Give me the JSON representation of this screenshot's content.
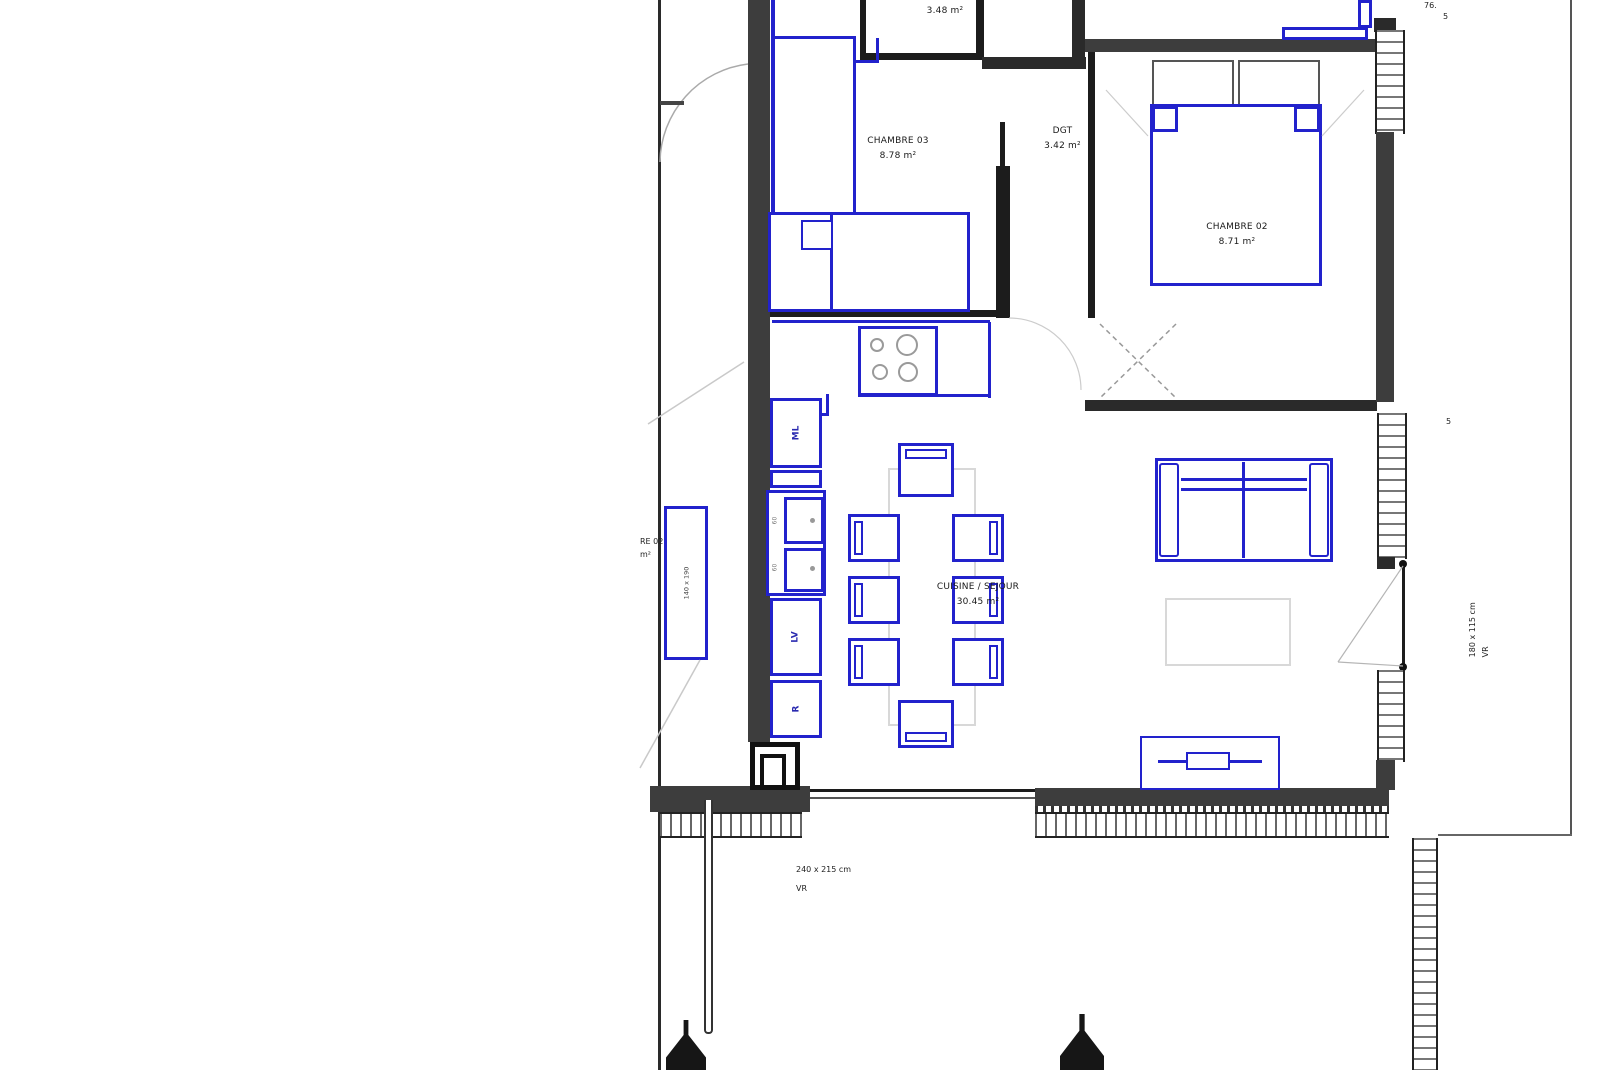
{
  "rooms": {
    "chambre03": {
      "name": "CHAMBRE 03",
      "area": "8.78 m²"
    },
    "bathroom_top": {
      "area": "3.48 m²"
    },
    "dgt": {
      "name": "DGT",
      "area": "3.42 m²"
    },
    "chambre02": {
      "name": "CHAMBRE 02",
      "area": "8.71 m²"
    },
    "cuisine_sejour": {
      "name": "CUISINE / SEJOUR",
      "area": "30.45 m²"
    },
    "neighbor_unit": {
      "name_partial": "RE 02",
      "area_partial": "m²",
      "bed_dimension": "140 x 190"
    }
  },
  "appliances": {
    "washing_machine": "ML",
    "dishwasher": "LV",
    "fridge": "R",
    "sink_dim_top": "60",
    "sink_dim_bottom": "60"
  },
  "openings": {
    "window_bottom_left": {
      "dimension": "240 x 215 cm",
      "shutter": "VR"
    },
    "window_right": {
      "dimension": "180 x 115 cm",
      "shutter": "VR"
    }
  },
  "annotations": {
    "top_right_line1": "76.",
    "top_right_line2": "5",
    "right_mid": "5"
  },
  "colors": {
    "wall_dark": "#3d3d3d",
    "wall_black": "#1c1c1c",
    "furniture_blue": "#2222cc",
    "faint_gray": "#d8d8d8"
  }
}
